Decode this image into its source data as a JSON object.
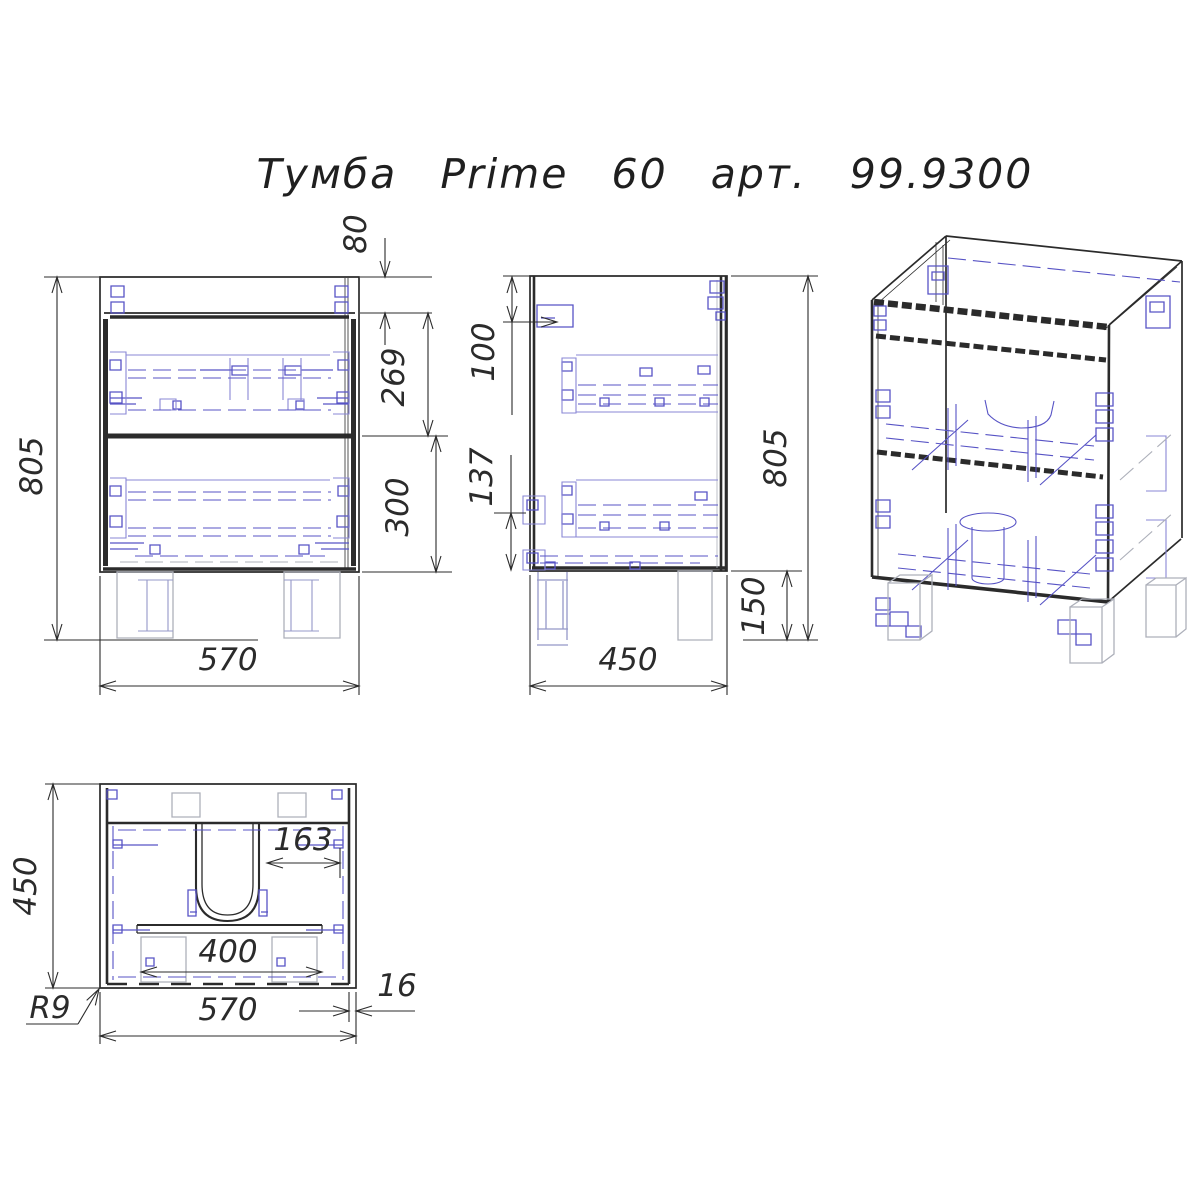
{
  "title": "Тумба Prime 60 арт. 99.9300",
  "colors": {
    "line": "#2b2b2b",
    "blue": "#5753c5",
    "lightblue": "#8a87d6",
    "gray": "#adb0ba",
    "bluegray": "#9598c8"
  },
  "front_view": {
    "dim_total_height": "805",
    "dim_top_gap": "80",
    "dim_upper_drawer": "269",
    "dim_lower_drawer": "300",
    "dim_width": "570"
  },
  "side_view": {
    "dim_fitting_offset": "100",
    "dim_bracket_offset": "137",
    "dim_total_height": "805",
    "dim_leg_height": "150",
    "dim_depth": "450"
  },
  "top_view": {
    "dim_depth": "450",
    "dim_cutout_offset": "163",
    "dim_stretcher_width": "400",
    "dim_corner_radius": "R9",
    "dim_width": "570",
    "dim_wall_thickness": "16"
  }
}
